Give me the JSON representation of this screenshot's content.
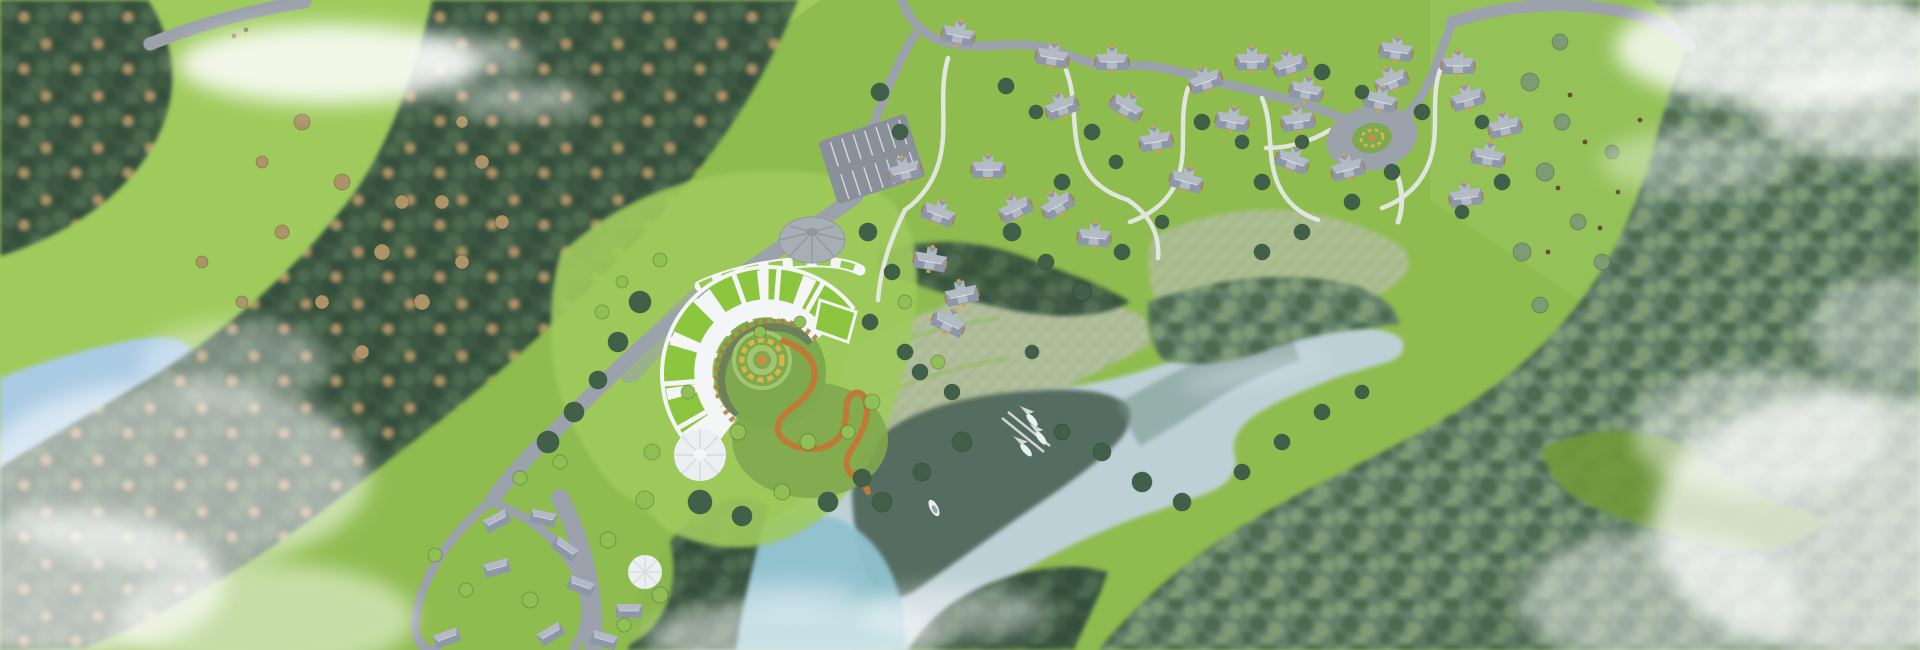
{
  "palette": {
    "meadow": "#8FBC4F",
    "meadow_light": "#9FCB5D",
    "meadow_right": "#94C258",
    "meadow_shadow": "#6F9A3A",
    "forest_dark": "#3E5943",
    "forest_mid": "#4D6B50",
    "forest_edge": "#35503C",
    "forest_hazy": "#64806A",
    "tree_conifer": "#41604A",
    "tree_deciduous": "#8FBF55",
    "tree_tan": "#AD9468",
    "tree_gray_green": "#7E9B74",
    "pond_blue": "#A9CBE3",
    "lake_pale": "#BDD0D6",
    "lake_mid": "#6F8F82",
    "lake_dark": "#4E6556",
    "lake_bottom": "#8FC2CE",
    "water_shine": "#D8E6EC",
    "road_gray": "#9BA2AB",
    "path_white": "#E9EBEE",
    "parking_gray": "#8A9099",
    "hotel_white": "#F3F5F6",
    "hotel_shadow": "#D7DBDE",
    "inner_ring": "#5A6166",
    "roof_green": "#8CC63F",
    "wood_accent": "#A97C3F",
    "garden_green": "#7FA94E",
    "garden_ring": "#A4C46F",
    "flower_gold": "#D7B54B",
    "flower_orange": "#C98E3F",
    "path_orange": "#BF7A35",
    "dome_gray": "#A7AEB4",
    "dome_dark": "#8F979E",
    "villa_roof": "#8D97A7",
    "villa_roof_light": "#B3BAC6",
    "villa_wall": "#A87E48",
    "villa_trim": "#D2A14C",
    "white_structure": "#ECEFF1",
    "grid_base": "#B5C1A3",
    "grid_line": "#8C9A7E",
    "boat_white": "#EDF0F2",
    "cloud_white": "#FFFFFF",
    "figure_brown": "#6B4A33"
  },
  "scene": {
    "clouds": [
      [
        328,
        64,
        150,
        40,
        0.85
      ],
      [
        470,
        56,
        62,
        18,
        0.5
      ],
      [
        522,
        100,
        72,
        17,
        0.45
      ],
      [
        235,
        362,
        95,
        42,
        0.35
      ],
      [
        175,
        475,
        195,
        95,
        0.55
      ],
      [
        55,
        585,
        170,
        75,
        0.65
      ],
      [
        265,
        618,
        150,
        55,
        0.5
      ],
      [
        795,
        638,
        150,
        38,
        0.5
      ],
      [
        955,
        612,
        95,
        26,
        0.4
      ],
      [
        1790,
        48,
        175,
        58,
        0.8
      ],
      [
        1878,
        112,
        125,
        48,
        0.6
      ],
      [
        1695,
        162,
        95,
        32,
        0.35
      ],
      [
        1858,
        525,
        205,
        135,
        0.7
      ],
      [
        1758,
        432,
        125,
        65,
        0.45
      ],
      [
        1902,
        330,
        95,
        55,
        0.4
      ],
      [
        1660,
        600,
        140,
        70,
        0.45
      ]
    ],
    "trees": {
      "conifer": [
        [
          640,
          302,
          11
        ],
        [
          618,
          342,
          10
        ],
        [
          598,
          380,
          9
        ],
        [
          574,
          412,
          10
        ],
        [
          548,
          442,
          11
        ],
        [
          700,
          502,
          12
        ],
        [
          742,
          516,
          10
        ],
        [
          828,
          502,
          10
        ],
        [
          862,
          478,
          9
        ],
        [
          880,
          92,
          9
        ],
        [
          900,
          132,
          8
        ],
        [
          868,
          232,
          9
        ],
        [
          892,
          272,
          8
        ],
        [
          1006,
          86,
          8
        ],
        [
          1036,
          112,
          7
        ],
        [
          1092,
          132,
          8
        ],
        [
          1116,
          162,
          7
        ],
        [
          1062,
          182,
          8
        ],
        [
          1012,
          232,
          9
        ],
        [
          1046,
          262,
          8
        ],
        [
          1082,
          292,
          9
        ],
        [
          1122,
          252,
          8
        ],
        [
          1162,
          222,
          7
        ],
        [
          1202,
          122,
          8
        ],
        [
          1242,
          142,
          7
        ],
        [
          1262,
          182,
          8
        ],
        [
          1302,
          142,
          7
        ],
        [
          1322,
          72,
          8
        ],
        [
          1362,
          92,
          7
        ],
        [
          1422,
          112,
          8
        ],
        [
          1392,
          172,
          8
        ],
        [
          1352,
          202,
          8
        ],
        [
          1302,
          232,
          8
        ],
        [
          1262,
          252,
          8
        ],
        [
          1482,
          122,
          7
        ],
        [
          1502,
          182,
          8
        ],
        [
          1462,
          212,
          7
        ],
        [
          962,
          442,
          10
        ],
        [
          922,
          472,
          9
        ],
        [
          882,
          502,
          10
        ],
        [
          1062,
          432,
          8
        ],
        [
          1102,
          452,
          9
        ],
        [
          1142,
          482,
          10
        ],
        [
          1182,
          502,
          9
        ],
        [
          1242,
          472,
          8
        ],
        [
          1282,
          442,
          8
        ],
        [
          1322,
          412,
          8
        ],
        [
          1362,
          392,
          7
        ],
        [
          920,
          372,
          8
        ],
        [
          952,
          392,
          8
        ],
        [
          1032,
          352,
          7
        ],
        [
          870,
          322,
          8
        ],
        [
          905,
          352,
          8
        ]
      ],
      "deciduous": [
        [
          688,
          392,
          7
        ],
        [
          738,
          432,
          8
        ],
        [
          808,
          442,
          8
        ],
        [
          848,
          432,
          7
        ],
        [
          872,
          402,
          8
        ],
        [
          760,
          332,
          6
        ],
        [
          800,
          322,
          6
        ],
        [
          652,
          452,
          8
        ],
        [
          782,
          492,
          8
        ],
        [
          602,
          312,
          7
        ],
        [
          660,
          260,
          7
        ],
        [
          622,
          282,
          6
        ],
        [
          645,
          500,
          9
        ],
        [
          608,
          540,
          8
        ],
        [
          660,
          595,
          8
        ],
        [
          624,
          625,
          7
        ],
        [
          530,
          600,
          8
        ],
        [
          466,
          590,
          7
        ],
        [
          435,
          555,
          7
        ],
        [
          520,
          478,
          7
        ],
        [
          560,
          462,
          7
        ],
        [
          905,
          302,
          7
        ],
        [
          938,
          362,
          7
        ]
      ],
      "tan": [
        [
          302,
          122,
          8
        ],
        [
          342,
          182,
          8
        ],
        [
          282,
          232,
          7
        ],
        [
          382,
          252,
          8
        ],
        [
          322,
          302,
          7
        ],
        [
          422,
          302,
          8
        ],
        [
          362,
          352,
          7
        ],
        [
          262,
          162,
          6
        ],
        [
          442,
          202,
          7
        ],
        [
          462,
          122,
          6
        ],
        [
          242,
          302,
          6
        ],
        [
          202,
          262,
          6
        ],
        [
          482,
          162,
          7
        ],
        [
          502,
          222,
          7
        ],
        [
          462,
          262,
          7
        ],
        [
          402,
          202,
          7
        ]
      ],
      "gray": [
        [
          1560,
          42,
          8
        ],
        [
          1530,
          82,
          9
        ],
        [
          1562,
          122,
          8
        ],
        [
          1545,
          172,
          9
        ],
        [
          1578,
          222,
          8
        ],
        [
          1522,
          252,
          9
        ],
        [
          1602,
          262,
          8
        ],
        [
          1612,
          152,
          7
        ],
        [
          1540,
          305,
          8
        ]
      ]
    },
    "buildings": {
      "chalets": [
        [
          905,
          172,
          -15
        ],
        [
          938,
          215,
          20
        ],
        [
          988,
          170,
          0
        ],
        [
          1016,
          210,
          -25
        ],
        [
          930,
          262,
          10
        ],
        [
          962,
          296,
          -12
        ],
        [
          948,
          324,
          25
        ],
        [
          1052,
          58,
          10
        ],
        [
          1062,
          108,
          -20
        ],
        [
          1112,
          62,
          0
        ],
        [
          1126,
          108,
          30
        ],
        [
          1156,
          142,
          -10
        ],
        [
          1186,
          182,
          15
        ],
        [
          1058,
          206,
          -30
        ],
        [
          1094,
          238,
          5
        ],
        [
          1206,
          82,
          -20
        ],
        [
          1232,
          122,
          10
        ],
        [
          1252,
          62,
          0
        ],
        [
          1290,
          66,
          -18
        ],
        [
          1306,
          92,
          12
        ],
        [
          1298,
          122,
          -8
        ],
        [
          1292,
          162,
          20
        ],
        [
          1348,
          170,
          -15
        ],
        [
          1396,
          52,
          8
        ],
        [
          1392,
          82,
          -22
        ],
        [
          1380,
          102,
          14
        ],
        [
          1458,
          66,
          0
        ],
        [
          1468,
          100,
          -16
        ],
        [
          1488,
          158,
          10
        ],
        [
          1466,
          198,
          -8
        ],
        [
          1505,
          128,
          -12
        ],
        [
          958,
          36,
          12
        ]
      ],
      "cottages": [
        [
          497,
          521,
          -28
        ],
        [
          543,
          518,
          12
        ],
        [
          565,
          549,
          35
        ],
        [
          497,
          568,
          -15
        ],
        [
          581,
          586,
          20
        ],
        [
          551,
          634,
          -30
        ],
        [
          604,
          640,
          15
        ],
        [
          447,
          638,
          -20
        ],
        [
          629,
          611,
          0
        ]
      ]
    },
    "boats": {
      "sailboats": [
        [
          1032,
          420,
          -40
        ],
        [
          1041,
          438,
          -38
        ],
        [
          1026,
          450,
          -42
        ]
      ],
      "motorboats": [
        [
          934,
          508,
          -28
        ]
      ]
    },
    "figures": [
      [
        1570,
        95
      ],
      [
        1585,
        142
      ],
      [
        1558,
        188
      ],
      [
        1600,
        228
      ],
      [
        1548,
        252
      ],
      [
        1618,
        192
      ],
      [
        234,
        36
      ],
      [
        246,
        30
      ],
      [
        1640,
        120
      ]
    ]
  }
}
